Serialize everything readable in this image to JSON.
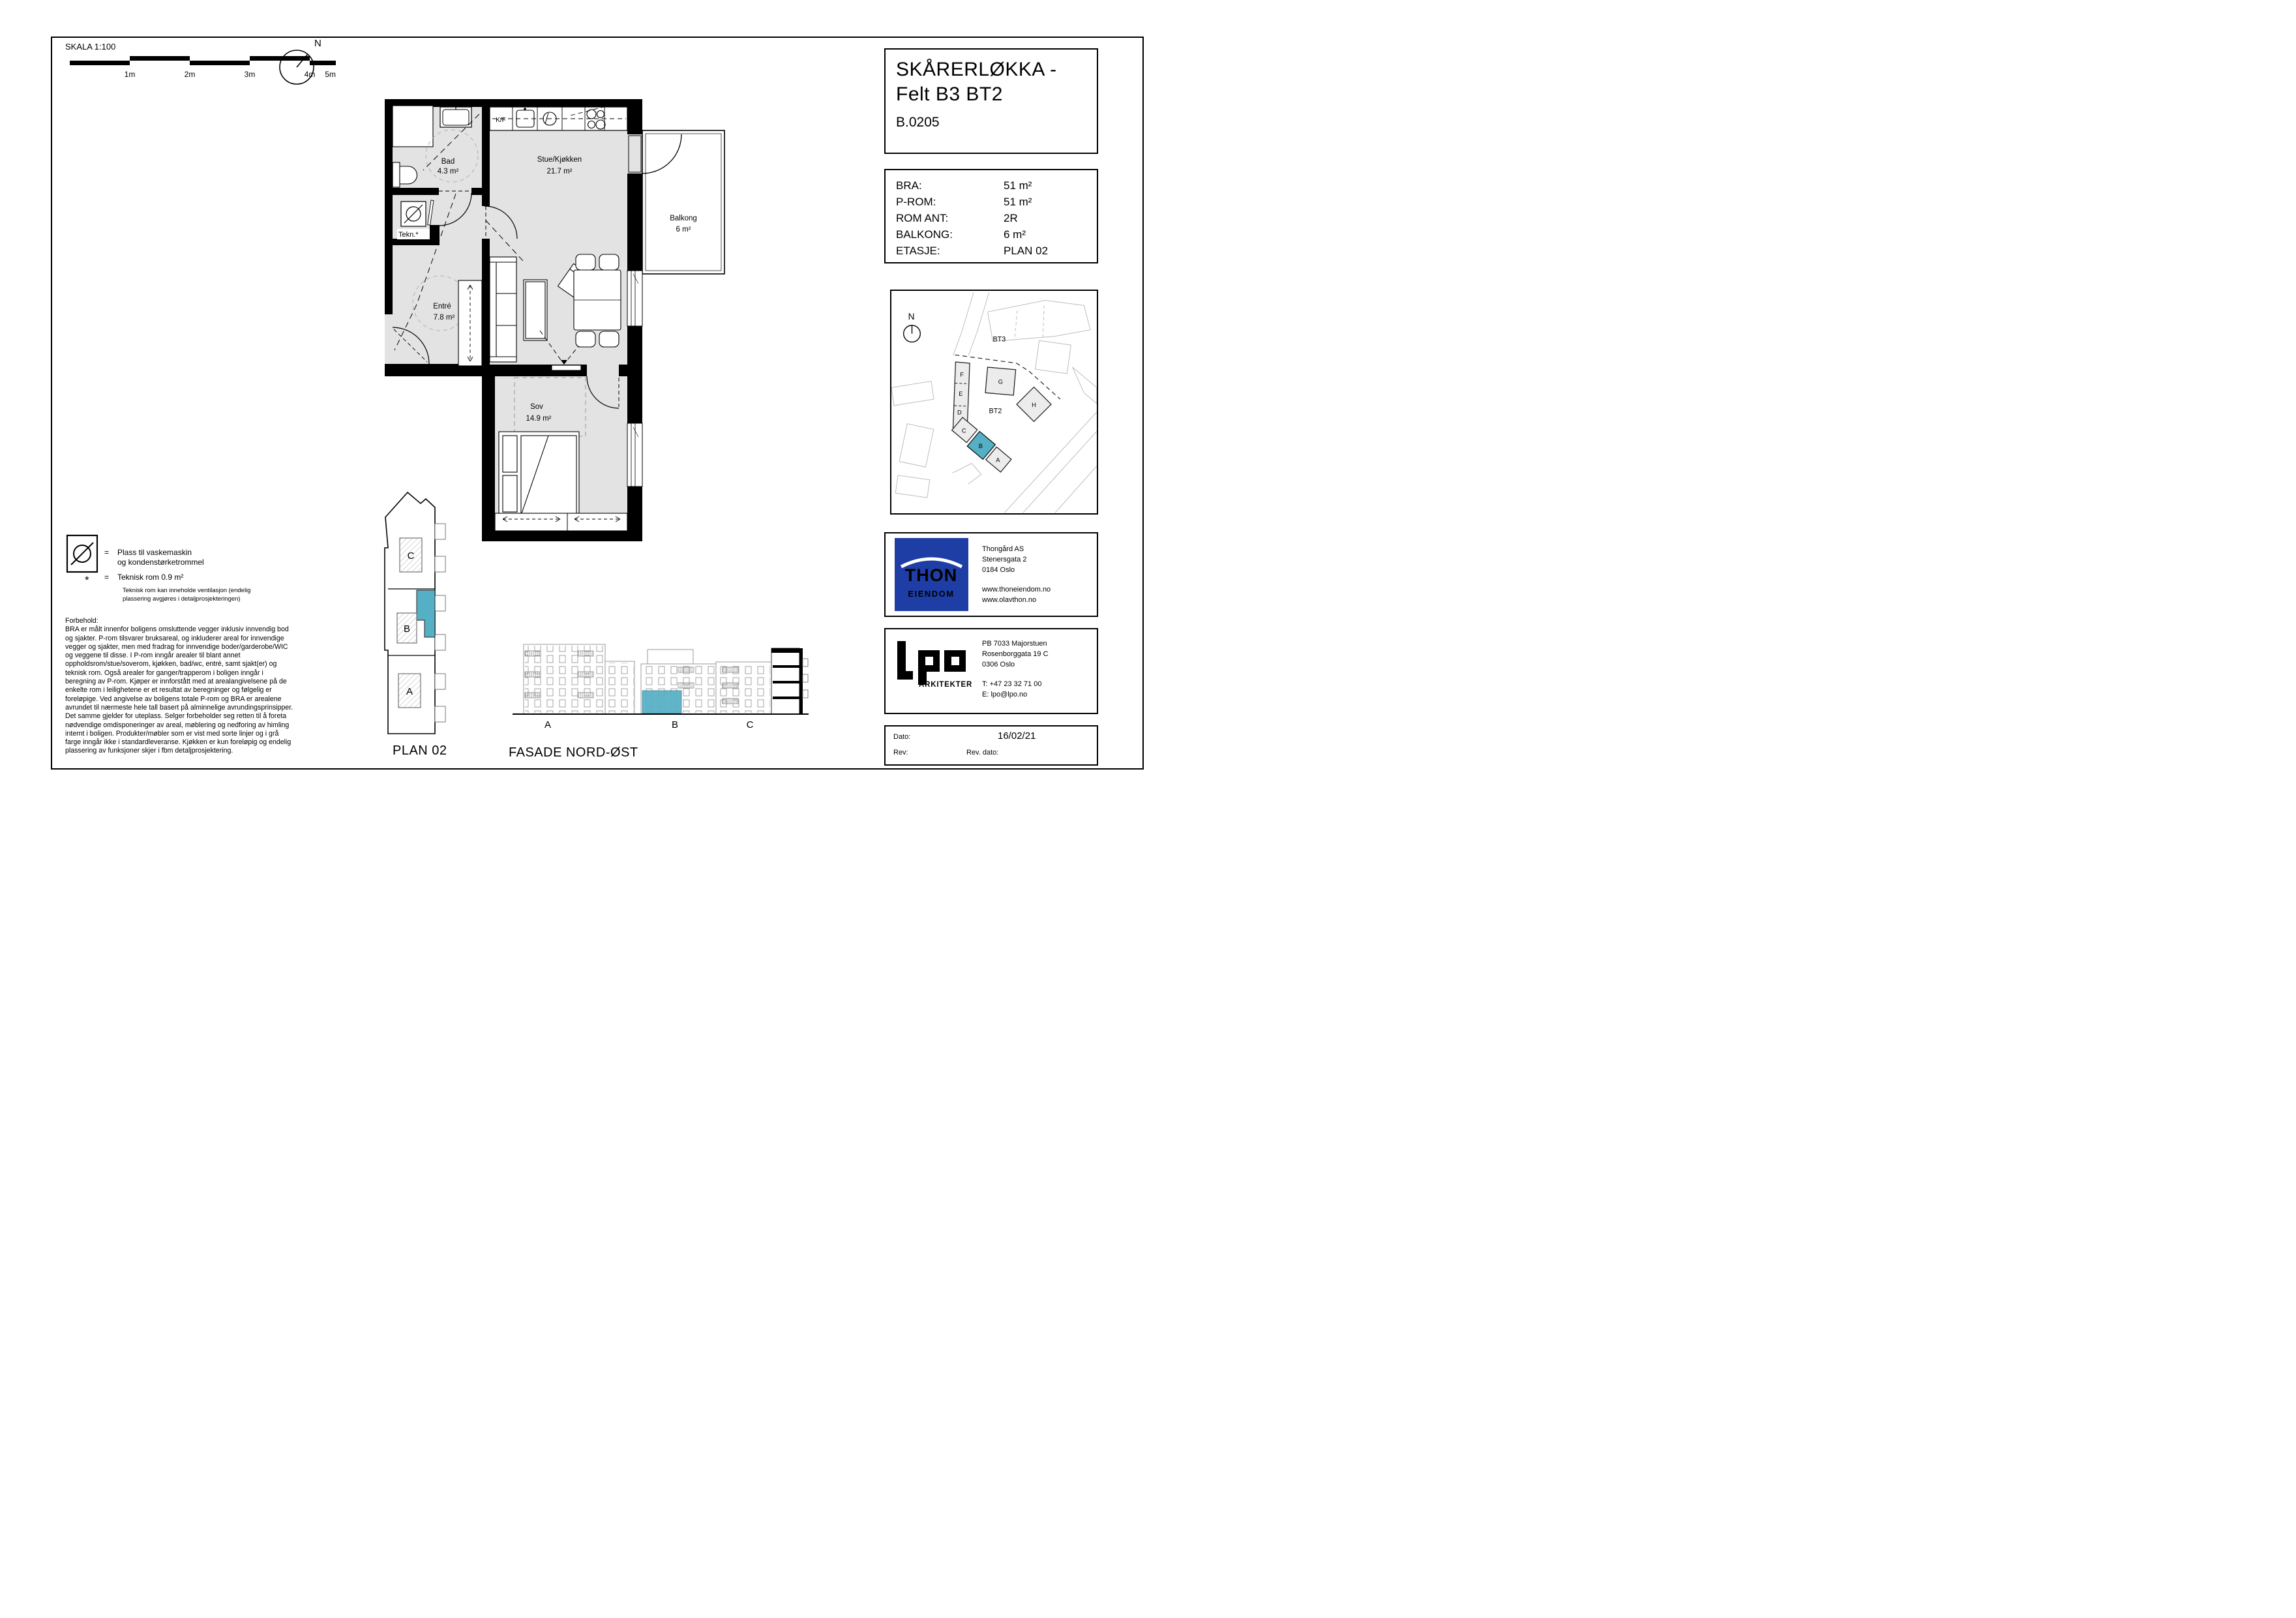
{
  "sheet": {
    "scale_label": "SKALA 1:100",
    "scale_ticks": [
      "1m",
      "2m",
      "3m",
      "4m",
      "5m"
    ],
    "north_label": "N"
  },
  "title_block": {
    "project_line1": "SKÅRERLØKKA -",
    "project_line2": "Felt B3 BT2",
    "unit_id": "B.0205"
  },
  "info": {
    "rows": [
      {
        "label": "BRA:",
        "value": "51 m²"
      },
      {
        "label": "P-ROM:",
        "value": "51 m²"
      },
      {
        "label": "ROM ANT:",
        "value": "2R"
      },
      {
        "label": "BALKONG:",
        "value": "6 m²"
      },
      {
        "label": "ETASJE:",
        "value": "PLAN 02"
      }
    ]
  },
  "floor_plan": {
    "rooms": [
      {
        "name": "Bad",
        "area": "4.3 m²"
      },
      {
        "name": "Stue/Kjøkken",
        "area": "21.7 m²"
      },
      {
        "name": "Balkong",
        "area": "6 m²"
      },
      {
        "name": "Tekn.*",
        "area": ""
      },
      {
        "name": "Entré",
        "area": "7.8 m²"
      },
      {
        "name": "Sov",
        "area": "14.9 m²"
      }
    ],
    "kitchen_label": "K/F"
  },
  "legend": {
    "washer_line1": "Plass til vaskemaskin",
    "washer_line2": "og kondenstørketrommel",
    "star_symbol": "*",
    "equals": "=",
    "tech_title": "Teknisk rom 0.9 m²",
    "tech_note1": "Teknisk rom kan inneholde ventilasjon (endelig",
    "tech_note2": "plassering avgjøres i detaljprosjekteringen)"
  },
  "disclaimer": {
    "heading": "Forbehold:",
    "lines": [
      "BRA er målt innenfor boligens omsluttende vegger inklusiv innvendig bod",
      "og sjakter. P-rom tilsvarer bruksareal, og inkluderer areal for innvendige",
      "vegger og sjakter, men med fradrag for innvendige boder/garderobe/WIC",
      "og veggene til disse. I P-rom inngår arealer til blant annet",
      "oppholdsrom/stue/soverom, kjøkken, bad/wc, entré, samt sjakt(er) og",
      "teknisk rom. Også arealer for ganger/trapperom i boligen inngår i",
      "beregning av P-rom. Kjøper er innforstått med at arealangivelsene på de",
      "enkelte rom i leilighetene er et resultat av beregninger og følgelig er",
      "foreløpige. Ved angivelse av boligens totale P-rom og BRA er arealene",
      "avrundet til nærmeste hele tall basert på alminnelige avrundingsprinsipper.",
      "Det samme gjelder for uteplass. Selger forbeholder seg retten til å foreta",
      "nødvendige omdisponeringer av areal, møblering og nedforing av himling",
      "internt i boligen. Produkter/møbler som er vist med sorte linjer og i grå",
      "farge inngår ikke i standardleveranse. Kjøkken er kun foreløpig og endelig",
      "plassering av funksjoner skjer i fbm  detaljprosjektering."
    ]
  },
  "site_map": {
    "north_label": "N",
    "bt3_label": "BT3",
    "bt2_label": "BT2",
    "buildings": [
      "F",
      "E",
      "D",
      "C",
      "B",
      "A",
      "G",
      "H"
    ],
    "highlighted": "B"
  },
  "plan_key": {
    "label": "PLAN 02",
    "sections": [
      "C",
      "B",
      "A"
    ]
  },
  "facade": {
    "label": "FASADE NORD-ØST",
    "sections": [
      "A",
      "B",
      "C"
    ]
  },
  "developer": {
    "logo_line1": "THON",
    "logo_line2": "EIENDOM",
    "name": "Thongård AS",
    "address1": "Stenersgata 2",
    "address2": "0184 Oslo",
    "web1": "www.thoneiendom.no",
    "web2": "www.olavthon.no"
  },
  "architect": {
    "logo_sub": "ARKITEKTER",
    "address1": "PB 7033 Majorstuen",
    "address2": "Rosenborggata 19 C",
    "address3": "0306 Oslo",
    "phone": "T: +47 23 32 71 00",
    "email": "E: lpo@lpo.no"
  },
  "revision": {
    "date_label": "Dato:",
    "date": "16/02/21",
    "rev_label": "Rev:",
    "rev_date_label": "Rev. dato:"
  },
  "colors": {
    "highlight": "#55afc5",
    "thon_blue": "#1e3ea6",
    "floor_gray": "#e3e3e3"
  }
}
